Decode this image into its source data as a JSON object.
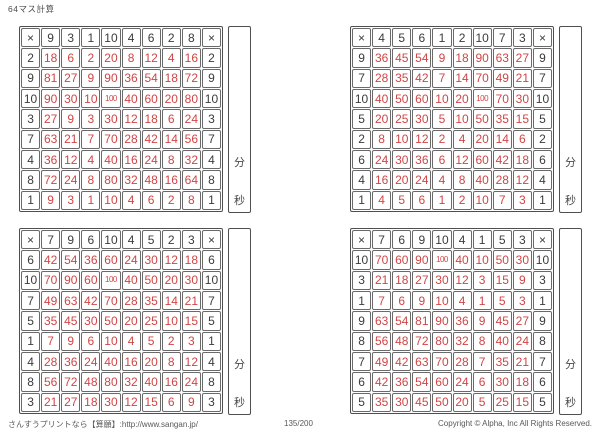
{
  "page": {
    "title": "64マス計算"
  },
  "multiplication_sign": "×",
  "timer": {
    "minutes_label": "分",
    "seconds_label": "秒"
  },
  "footer": {
    "site": "さんすうプリントなら【算願】:http://www.sangan.jp/",
    "page_number": "135/200",
    "copyright": "Copyright © Alpha, Inc All Rights Reserved."
  },
  "grids": [
    {
      "position": "top-left",
      "header_factors": [
        "9",
        "3",
        "1",
        "10",
        "4",
        "6",
        "2",
        "8"
      ],
      "rows": [
        {
          "factor": "2",
          "products": [
            "18",
            "6",
            "2",
            "20",
            "8",
            "12",
            "4",
            "16"
          ]
        },
        {
          "factor": "9",
          "products": [
            "81",
            "27",
            "9",
            "90",
            "36",
            "54",
            "18",
            "72"
          ]
        },
        {
          "factor": "10",
          "products": [
            "90",
            "30",
            "10",
            "100",
            "40",
            "60",
            "20",
            "80"
          ]
        },
        {
          "factor": "3",
          "products": [
            "27",
            "9",
            "3",
            "30",
            "12",
            "18",
            "6",
            "24"
          ]
        },
        {
          "factor": "7",
          "products": [
            "63",
            "21",
            "7",
            "70",
            "28",
            "42",
            "14",
            "56"
          ]
        },
        {
          "factor": "4",
          "products": [
            "36",
            "12",
            "4",
            "40",
            "16",
            "24",
            "8",
            "32"
          ]
        },
        {
          "factor": "8",
          "products": [
            "72",
            "24",
            "8",
            "80",
            "32",
            "48",
            "16",
            "64"
          ]
        },
        {
          "factor": "1",
          "products": [
            "9",
            "3",
            "1",
            "10",
            "4",
            "6",
            "2",
            "8"
          ]
        }
      ]
    },
    {
      "position": "top-right",
      "header_factors": [
        "4",
        "5",
        "6",
        "1",
        "2",
        "10",
        "7",
        "3"
      ],
      "rows": [
        {
          "factor": "9",
          "products": [
            "36",
            "45",
            "54",
            "9",
            "18",
            "90",
            "63",
            "27"
          ]
        },
        {
          "factor": "7",
          "products": [
            "28",
            "35",
            "42",
            "7",
            "14",
            "70",
            "49",
            "21"
          ]
        },
        {
          "factor": "10",
          "products": [
            "40",
            "50",
            "60",
            "10",
            "20",
            "100",
            "70",
            "30"
          ]
        },
        {
          "factor": "5",
          "products": [
            "20",
            "25",
            "30",
            "5",
            "10",
            "50",
            "35",
            "15"
          ]
        },
        {
          "factor": "2",
          "products": [
            "8",
            "10",
            "12",
            "2",
            "4",
            "20",
            "14",
            "6"
          ]
        },
        {
          "factor": "6",
          "products": [
            "24",
            "30",
            "36",
            "6",
            "12",
            "60",
            "42",
            "18"
          ]
        },
        {
          "factor": "4",
          "products": [
            "16",
            "20",
            "24",
            "4",
            "8",
            "40",
            "28",
            "12"
          ]
        },
        {
          "factor": "1",
          "products": [
            "4",
            "5",
            "6",
            "1",
            "2",
            "10",
            "7",
            "3"
          ]
        }
      ]
    },
    {
      "position": "bottom-left",
      "header_factors": [
        "7",
        "9",
        "6",
        "10",
        "4",
        "5",
        "2",
        "3"
      ],
      "rows": [
        {
          "factor": "6",
          "products": [
            "42",
            "54",
            "36",
            "60",
            "24",
            "30",
            "12",
            "18"
          ]
        },
        {
          "factor": "10",
          "products": [
            "70",
            "90",
            "60",
            "100",
            "40",
            "50",
            "20",
            "30"
          ]
        },
        {
          "factor": "7",
          "products": [
            "49",
            "63",
            "42",
            "70",
            "28",
            "35",
            "14",
            "21"
          ]
        },
        {
          "factor": "5",
          "products": [
            "35",
            "45",
            "30",
            "50",
            "20",
            "25",
            "10",
            "15"
          ]
        },
        {
          "factor": "1",
          "products": [
            "7",
            "9",
            "6",
            "10",
            "4",
            "5",
            "2",
            "3"
          ]
        },
        {
          "factor": "4",
          "products": [
            "28",
            "36",
            "24",
            "40",
            "16",
            "20",
            "8",
            "12"
          ]
        },
        {
          "factor": "8",
          "products": [
            "56",
            "72",
            "48",
            "80",
            "32",
            "40",
            "16",
            "24"
          ]
        },
        {
          "factor": "3",
          "products": [
            "21",
            "27",
            "18",
            "30",
            "12",
            "15",
            "6",
            "9"
          ]
        }
      ]
    },
    {
      "position": "bottom-right",
      "header_factors": [
        "7",
        "6",
        "9",
        "10",
        "4",
        "1",
        "5",
        "3"
      ],
      "rows": [
        {
          "factor": "10",
          "products": [
            "70",
            "60",
            "90",
            "100",
            "40",
            "10",
            "50",
            "30"
          ]
        },
        {
          "factor": "3",
          "products": [
            "21",
            "18",
            "27",
            "30",
            "12",
            "3",
            "15",
            "9"
          ]
        },
        {
          "factor": "1",
          "products": [
            "7",
            "6",
            "9",
            "10",
            "4",
            "1",
            "5",
            "3"
          ]
        },
        {
          "factor": "9",
          "products": [
            "63",
            "54",
            "81",
            "90",
            "36",
            "9",
            "45",
            "27"
          ]
        },
        {
          "factor": "8",
          "products": [
            "56",
            "48",
            "72",
            "80",
            "32",
            "8",
            "40",
            "24"
          ]
        },
        {
          "factor": "7",
          "products": [
            "49",
            "42",
            "63",
            "70",
            "28",
            "7",
            "35",
            "21"
          ]
        },
        {
          "factor": "6",
          "products": [
            "42",
            "36",
            "54",
            "60",
            "24",
            "6",
            "30",
            "18"
          ]
        },
        {
          "factor": "5",
          "products": [
            "35",
            "30",
            "45",
            "50",
            "20",
            "5",
            "25",
            "15"
          ]
        }
      ]
    }
  ]
}
